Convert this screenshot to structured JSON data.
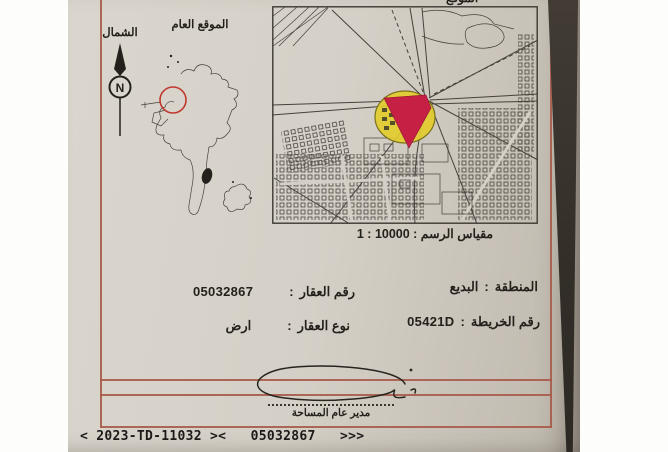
{
  "colors": {
    "paper": "#d5d0c7",
    "frame_red": "#a85a49",
    "ink": "#24211c",
    "map_line": "#45413b",
    "plot_yellow": "#e2cb2e",
    "plot_red": "#c62045",
    "location_circle_red": "#c0392b",
    "photo_edge_dark": "#38322b",
    "machine_text": "#1b1a18"
  },
  "compass": {
    "label": "الشمال",
    "letter": "N"
  },
  "overview_map": {
    "title": "الموقع العام"
  },
  "detail_map": {
    "clipped_title": "الموقع",
    "scale_text": "مقياس الرسم : 10000 : 1"
  },
  "fields": {
    "separator": ":",
    "region": {
      "label": "المنطقة",
      "value": "البديع"
    },
    "map_number": {
      "label": "رقم الخريطة",
      "value": "05421D"
    },
    "parcel_number": {
      "label": "رقم العقار",
      "value": "05032867"
    },
    "parcel_type": {
      "label": "نوع العقار",
      "value": "ارض"
    }
  },
  "signature": {
    "title": "مدير عام المساحة"
  },
  "footer": {
    "machine_line": "< 2023-TD-11032 ><   05032867   >>>"
  }
}
